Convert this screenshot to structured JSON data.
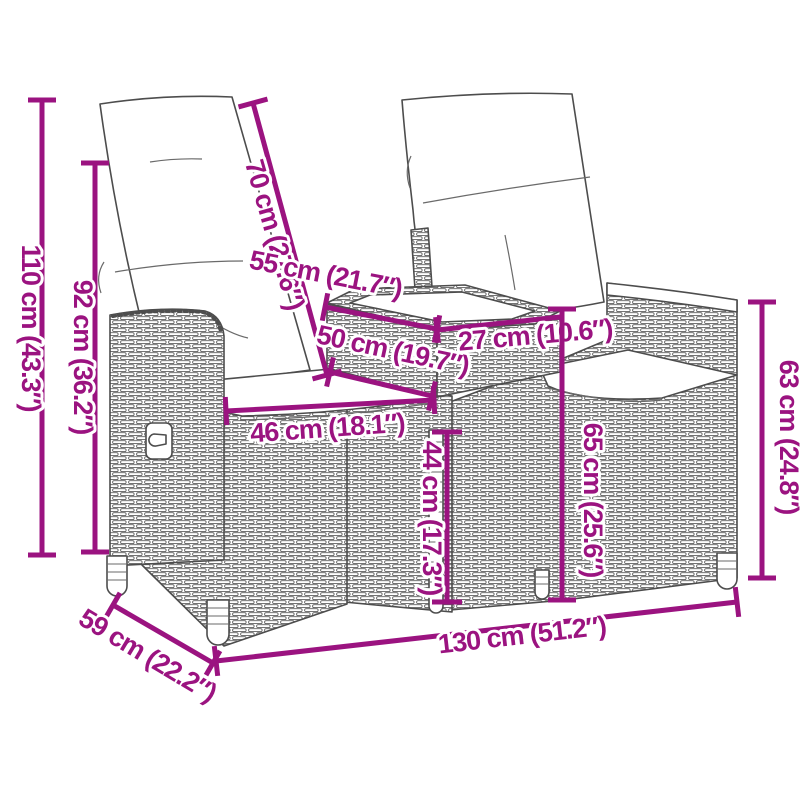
{
  "colors": {
    "dimension_accent": "#9B1380",
    "line_art": "#4D4D4D",
    "background": "#FFFFFF"
  },
  "dims": [
    {
      "label": "110 cm (43.3″)"
    },
    {
      "label": "92 cm (36.2″)"
    },
    {
      "label": "70 cm (27.6″)"
    },
    {
      "label": "55 cm (21.7″)"
    },
    {
      "label": "27 cm (10.6″)"
    },
    {
      "label": "50 cm (19.7″)"
    },
    {
      "label": "46 cm (18.1″)"
    },
    {
      "label": "44 cm (17.3″)"
    },
    {
      "label": "65 cm (25.6″)"
    },
    {
      "label": "63 cm (24.8″)"
    },
    {
      "label": "130 cm (51.2″)"
    },
    {
      "label": "59 cm (22.2″)"
    }
  ]
}
